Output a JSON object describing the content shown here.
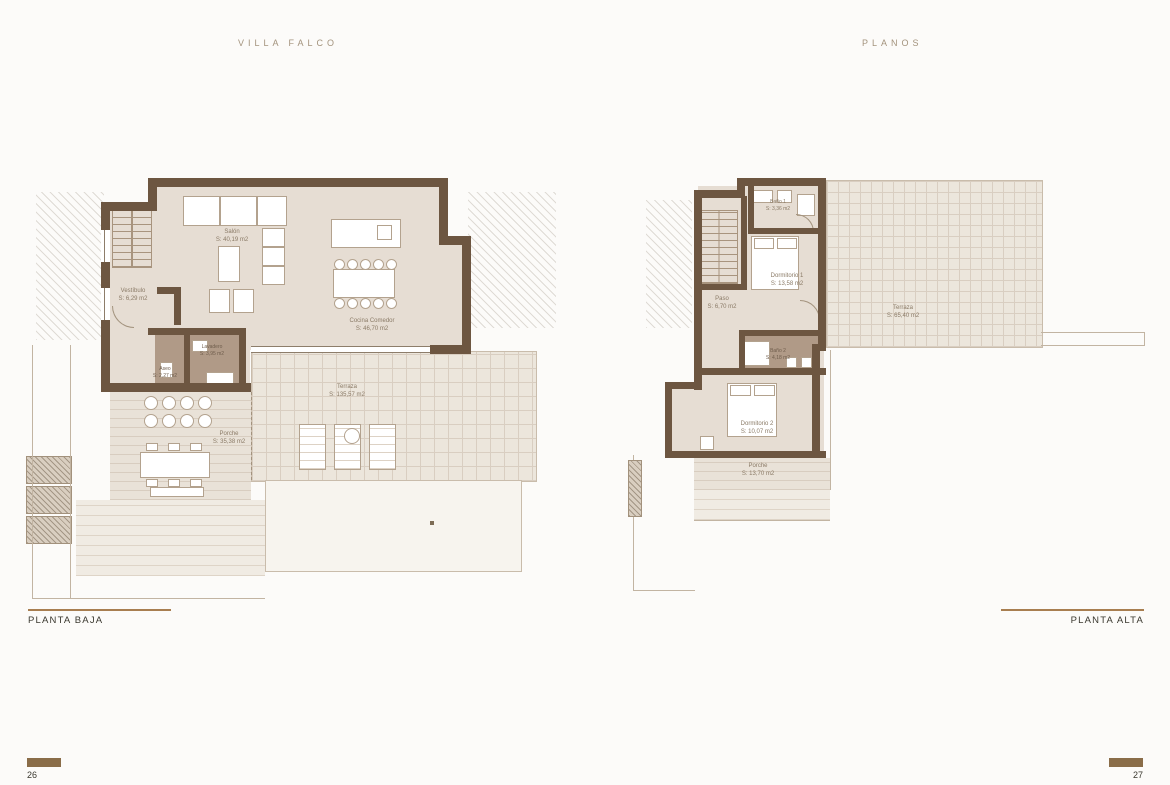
{
  "header": {
    "left": "VILLA FALCO",
    "right": "PLANOS"
  },
  "colors": {
    "wall_brown": "#6d5641",
    "room_beige": "#e6ddd3",
    "wet_room_mauve": "#b09a87",
    "terrace_grid": "#d9cec1",
    "caption_rule_tan": "#a87e50",
    "page_bar_brown": "#8a6d49",
    "header_text": "#a3937d",
    "caption_text": "#3a382f"
  },
  "plans": {
    "baja": {
      "caption": "PLANTA BAJA",
      "page": "26",
      "rooms": [
        {
          "name": "Salón",
          "area": "S: 40,19 m2"
        },
        {
          "name": "Vestíbulo",
          "area": "S: 6,29 m2"
        },
        {
          "name": "Cocina Comedor",
          "area": "S: 46,70 m2"
        },
        {
          "name": "Lavadero",
          "area": "S: 3,95 m2"
        },
        {
          "name": "Aseo",
          "area": "S: 2,27 m2"
        },
        {
          "name": "Terraza",
          "area": "S: 135,57 m2"
        },
        {
          "name": "Porche",
          "area": "S: 35,38 m2"
        }
      ]
    },
    "alta": {
      "caption": "PLANTA ALTA",
      "page": "27",
      "rooms": [
        {
          "name": "Baño 1",
          "area": "S: 3,36 m2"
        },
        {
          "name": "Dormitorio 1",
          "area": "S: 13,58 m2"
        },
        {
          "name": "Paso",
          "area": "S: 6,70 m2"
        },
        {
          "name": "Terraza",
          "area": "S: 65,40 m2"
        },
        {
          "name": "Baño 2",
          "area": "S: 4,18 m2"
        },
        {
          "name": "Dormitorio 2",
          "area": "S: 10,07 m2"
        },
        {
          "name": "Porche",
          "area": "S: 13,70 m2"
        }
      ]
    }
  }
}
